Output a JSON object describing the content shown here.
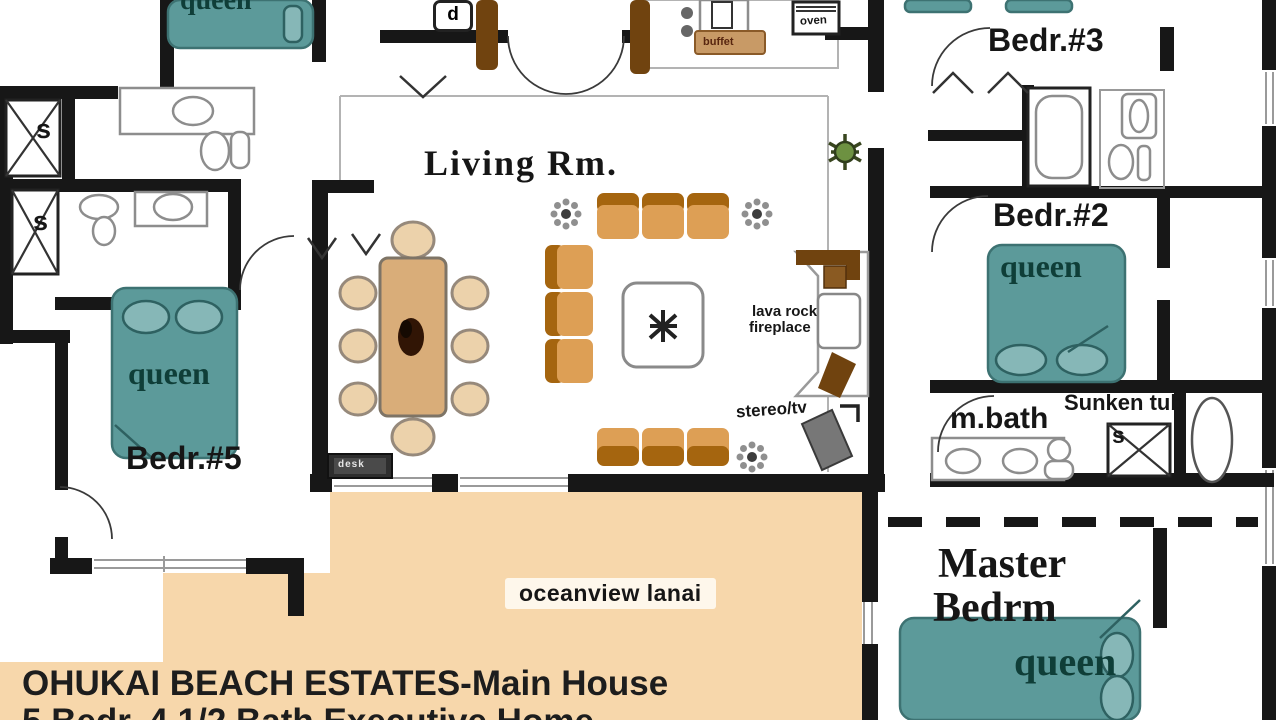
{
  "plan": {
    "header": {
      "title_line1": "OHUKAI BEACH ESTATES-Main House",
      "title_line2": "5 Bedr. 4 1/2 Bath Executive Home"
    },
    "rooms": {
      "living": "Living Rm.",
      "bedr3": "Bedr.#3",
      "bedr2": "Bedr.#2",
      "bedr5": "Bedr.#5",
      "master_line1": "Master",
      "master_line2": "Bedrm",
      "mbath": "m.bath",
      "lanai": "oceanview lanai"
    },
    "labels": {
      "queen": "queen",
      "sunken_tub": "Sunken tub",
      "fireplace_l1": "lava rock",
      "fireplace_l2": "fireplace",
      "stereo": "stereo/tv",
      "buffet": "buffet",
      "oven": "oven",
      "dryer": "d",
      "shower": "s",
      "desk": "desk"
    },
    "colors": {
      "wall": "#171717",
      "bed_teal": "#5c9a9a",
      "lanai_peach": "#f7d7ab",
      "wood": "#d9ad79",
      "sofa": "#dd9f55"
    }
  }
}
